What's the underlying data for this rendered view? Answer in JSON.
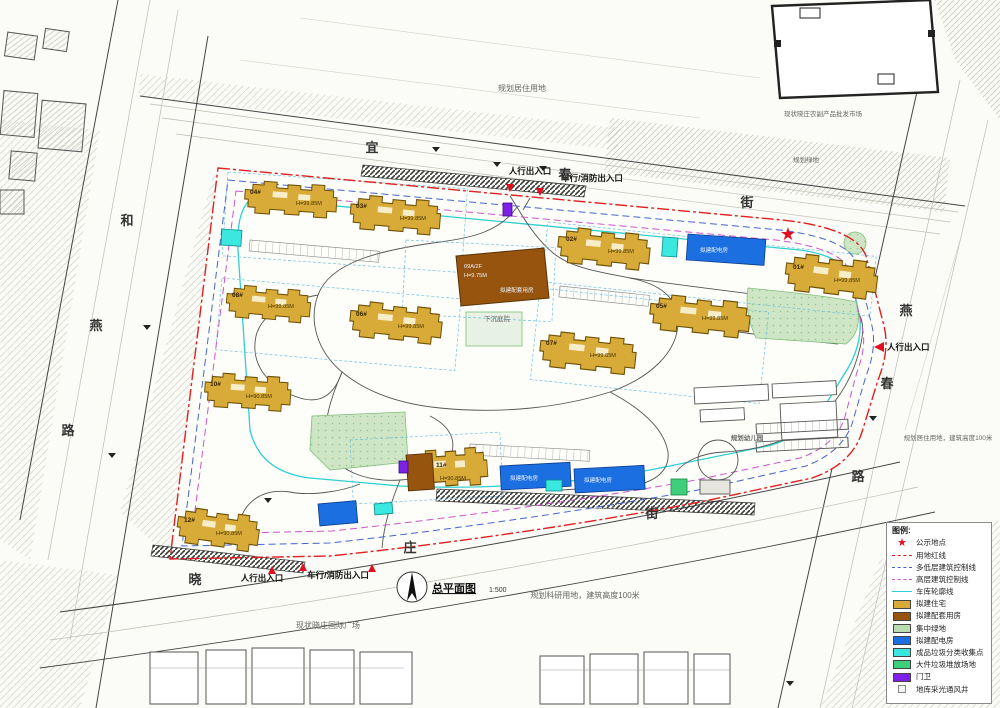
{
  "colors": {
    "residential": "#d8ab39",
    "support": "#96540f",
    "green_central": "#bfe0b6",
    "power": "#1b6fe0",
    "waste_cyan": "#3ae8e0",
    "waste_green": "#3fcf7a",
    "guard": "#7d20e8",
    "red_line": "#e02020",
    "lowrise_line": "#4466cc",
    "highrise_line": "#cc55cc",
    "garage_line": "#2fd0d0",
    "star": "#e01020"
  },
  "title": {
    "name": "总平面图",
    "scale": "1:500"
  },
  "streets": {
    "top": [
      "宜",
      "春",
      "街"
    ],
    "right": [
      "燕",
      "春",
      "路"
    ],
    "left": [
      "和",
      "燕",
      "路"
    ],
    "bottom": [
      "晓",
      "庄",
      "街"
    ]
  },
  "entrances": {
    "top_pedestrian": "人行出入口",
    "top_vehicle": "车行/消防出入口",
    "right_pedestrian": "人行出入口",
    "bottom_pedestrian": "人行出入口",
    "bottom_vehicle": "车行/消防出入口"
  },
  "annotations": {
    "north_parcel": "规划居住用地",
    "northeast_market": "现状晓庄农副产品批发市场",
    "northeast_green": "规划绿地",
    "east_parcel": "规划居住用地，建筑高度100米",
    "south_parcel": "规划科研用地，建筑高度100米",
    "south_plaza": "现状晓庄国际广场",
    "sunken_courtyard": "下沉庭院",
    "kindergarten": "规划幼儿园",
    "garage_ramp": "地下车库出入口",
    "power_room": "拟建配电房"
  },
  "service_building": {
    "label": "09A/2F",
    "height": "H=9.75M",
    "note": "拟建配套用房"
  },
  "buildings": [
    {
      "label": "04#",
      "height": "H=99.85M"
    },
    {
      "label": "03#",
      "height": "H=99.85M"
    },
    {
      "label": "02#",
      "height": "H=99.85M"
    },
    {
      "label": "01#",
      "height": "H=99.85M"
    },
    {
      "label": "08#",
      "height": "H=99.85M"
    },
    {
      "label": "06#",
      "height": "H=99.85M"
    },
    {
      "label": "07#",
      "height": "H=99.85M"
    },
    {
      "label": "05#",
      "height": "H=99.85M"
    },
    {
      "label": "10#",
      "height": "H=90.85M"
    },
    {
      "label": "11#",
      "height": "H=90.85M"
    },
    {
      "label": "12#",
      "height": "H=90.85M"
    }
  ],
  "legend": {
    "title": "图例:",
    "items": [
      {
        "label": "公示地点",
        "type": "star"
      },
      {
        "label": "用地红线",
        "type": "line-red"
      },
      {
        "label": "多低层建筑控制线",
        "type": "line-blue"
      },
      {
        "label": "高层建筑控制线",
        "type": "line-magenta"
      },
      {
        "label": "车库轮廓线",
        "type": "line-cyan"
      },
      {
        "label": "拟建住宅",
        "type": "swatch-gold"
      },
      {
        "label": "拟建配套用房",
        "type": "swatch-brown"
      },
      {
        "label": "集中绿地",
        "type": "swatch-lightgreen"
      },
      {
        "label": "拟建配电房",
        "type": "swatch-blue"
      },
      {
        "label": "成品垃圾分类收集点",
        "type": "swatch-cyan"
      },
      {
        "label": "大件垃圾堆放场地",
        "type": "swatch-green"
      },
      {
        "label": "门卫",
        "type": "swatch-purple"
      },
      {
        "label": "地库采光通风井",
        "type": "square"
      }
    ]
  }
}
